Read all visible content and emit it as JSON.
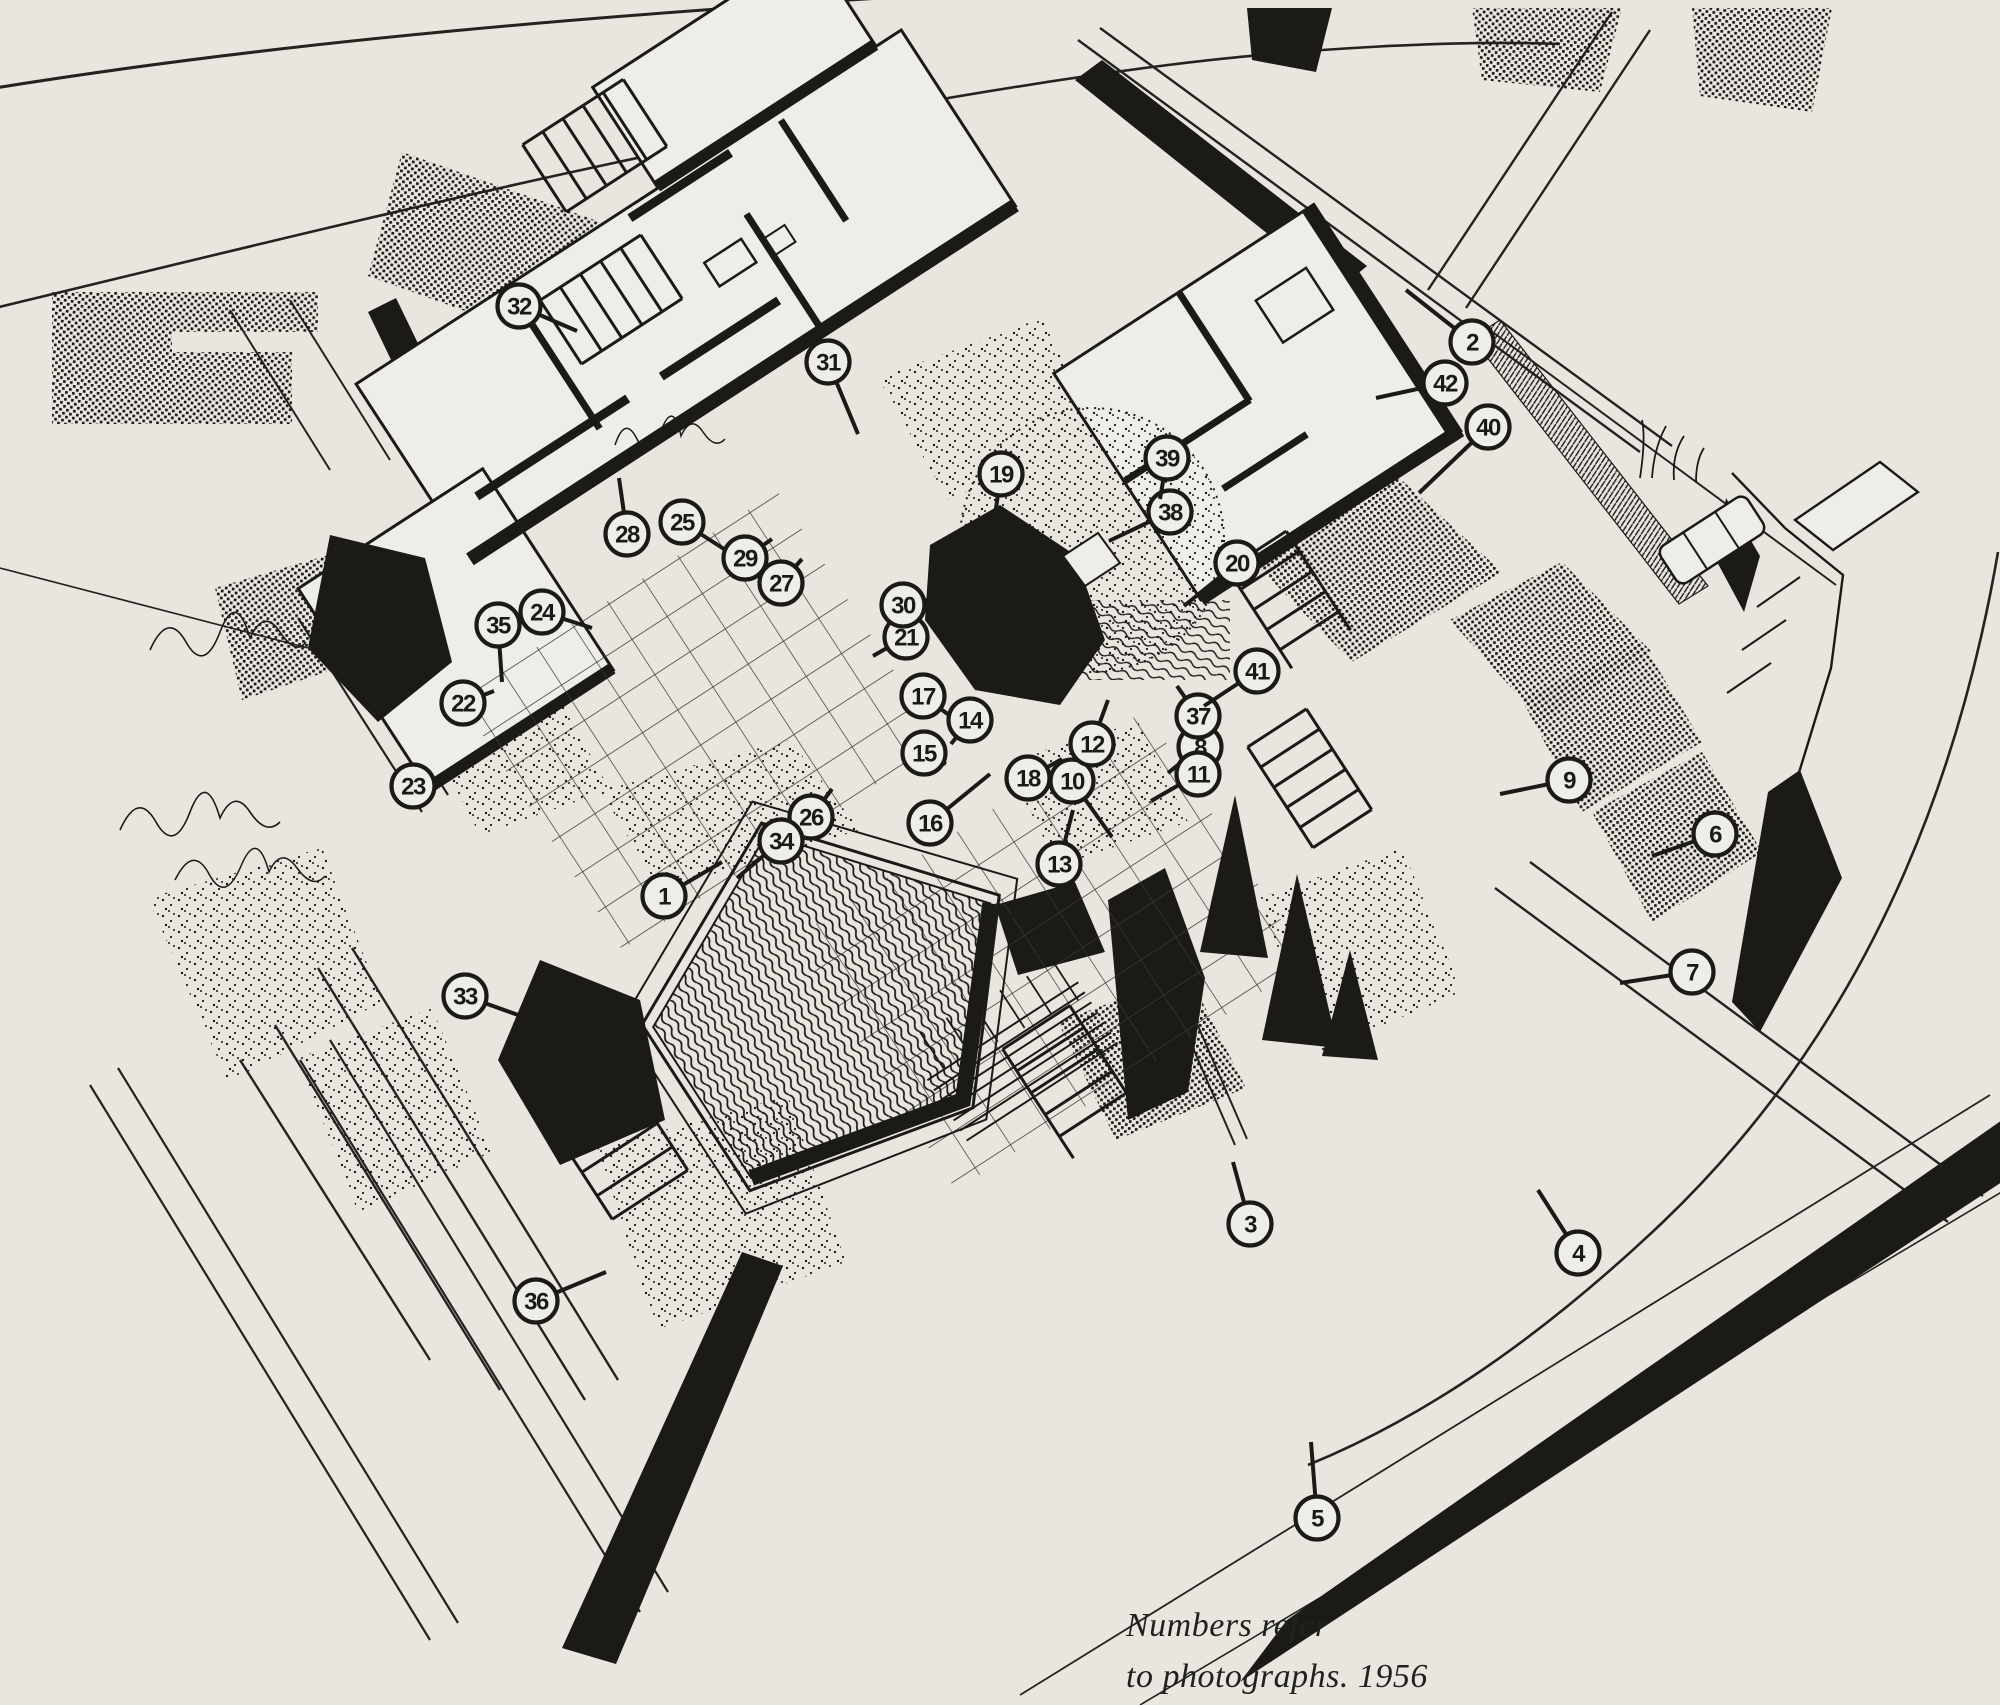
{
  "document": {
    "title": "Axonometric site plan drawing with numbered photo keys",
    "caption_line1": "Numbers refer",
    "caption_line2": "to photographs. 1956",
    "year": "1956"
  },
  "palette": {
    "paper": "#e9e6e0",
    "paper_light": "#efede7",
    "ink": "#1b1a16"
  },
  "markers": [
    {
      "n": "1",
      "x": 664,
      "y": 896,
      "lx": 722,
      "ly": 862
    },
    {
      "n": "2",
      "x": 1472,
      "y": 342,
      "lx": 1406,
      "ly": 290
    },
    {
      "n": "3",
      "x": 1250,
      "y": 1224,
      "lx": 1233,
      "ly": 1162
    },
    {
      "n": "4",
      "x": 1578,
      "y": 1253,
      "lx": 1538,
      "ly": 1190
    },
    {
      "n": "5",
      "x": 1317,
      "y": 1518,
      "lx": 1311,
      "ly": 1442
    },
    {
      "n": "6",
      "x": 1715,
      "y": 834,
      "lx": 1652,
      "ly": 856
    },
    {
      "n": "7",
      "x": 1692,
      "y": 972,
      "lx": 1620,
      "ly": 983
    },
    {
      "n": "8",
      "x": 1200,
      "y": 747,
      "lx": 1168,
      "ly": 773
    },
    {
      "n": "9",
      "x": 1569,
      "y": 780,
      "lx": 1500,
      "ly": 794
    },
    {
      "n": "10",
      "x": 1072,
      "y": 781,
      "lx": 1112,
      "ly": 837
    },
    {
      "n": "11",
      "x": 1198,
      "y": 774,
      "lx": 1151,
      "ly": 801
    },
    {
      "n": "12",
      "x": 1092,
      "y": 744,
      "lx": 1108,
      "ly": 700
    },
    {
      "n": "13",
      "x": 1059,
      "y": 864,
      "lx": 1073,
      "ly": 810
    },
    {
      "n": "14",
      "x": 970,
      "y": 720,
      "lx": 951,
      "ly": 744
    },
    {
      "n": "15",
      "x": 924,
      "y": 753,
      "lx": 946,
      "ly": 764
    },
    {
      "n": "16",
      "x": 930,
      "y": 823,
      "lx": 990,
      "ly": 774
    },
    {
      "n": "17",
      "x": 923,
      "y": 696,
      "lx": 949,
      "ly": 715
    },
    {
      "n": "18",
      "x": 1028,
      "y": 778,
      "lx": 1062,
      "ly": 759
    },
    {
      "n": "19",
      "x": 1001,
      "y": 474,
      "lx": 994,
      "ly": 522
    },
    {
      "n": "20",
      "x": 1237,
      "y": 563,
      "lx": 1184,
      "ly": 606
    },
    {
      "n": "21",
      "x": 906,
      "y": 637,
      "lx": 873,
      "ly": 656
    },
    {
      "n": "22",
      "x": 463,
      "y": 703,
      "lx": 494,
      "ly": 691
    },
    {
      "n": "23",
      "x": 413,
      "y": 786,
      "lx": 452,
      "ly": 777
    },
    {
      "n": "24",
      "x": 542,
      "y": 612,
      "lx": 592,
      "ly": 628
    },
    {
      "n": "25",
      "x": 682,
      "y": 522,
      "lx": 724,
      "ly": 549
    },
    {
      "n": "26",
      "x": 811,
      "y": 817,
      "lx": 832,
      "ly": 789
    },
    {
      "n": "27",
      "x": 781,
      "y": 583,
      "lx": 802,
      "ly": 559
    },
    {
      "n": "28",
      "x": 627,
      "y": 534,
      "lx": 619,
      "ly": 478
    },
    {
      "n": "29",
      "x": 745,
      "y": 558,
      "lx": 772,
      "ly": 539
    },
    {
      "n": "30",
      "x": 903,
      "y": 605,
      "lx": 960,
      "ly": 593
    },
    {
      "n": "31",
      "x": 828,
      "y": 362,
      "lx": 858,
      "ly": 434
    },
    {
      "n": "32",
      "x": 519,
      "y": 306,
      "lx": 577,
      "ly": 331
    },
    {
      "n": "33",
      "x": 465,
      "y": 996,
      "lx": 521,
      "ly": 1016
    },
    {
      "n": "34",
      "x": 781,
      "y": 841,
      "lx": 737,
      "ly": 878
    },
    {
      "n": "35",
      "x": 498,
      "y": 625,
      "lx": 502,
      "ly": 682
    },
    {
      "n": "36",
      "x": 536,
      "y": 1301,
      "lx": 606,
      "ly": 1272
    },
    {
      "n": "37",
      "x": 1198,
      "y": 716,
      "lx": 1177,
      "ly": 686
    },
    {
      "n": "38",
      "x": 1170,
      "y": 512,
      "lx": 1109,
      "ly": 541
    },
    {
      "n": "39",
      "x": 1167,
      "y": 458,
      "lx": 1160,
      "ly": 499
    },
    {
      "n": "40",
      "x": 1488,
      "y": 427,
      "lx": 1419,
      "ly": 493
    },
    {
      "n": "41",
      "x": 1257,
      "y": 671,
      "lx": 1204,
      "ly": 706
    },
    {
      "n": "42",
      "x": 1445,
      "y": 383,
      "lx": 1376,
      "ly": 398
    }
  ]
}
